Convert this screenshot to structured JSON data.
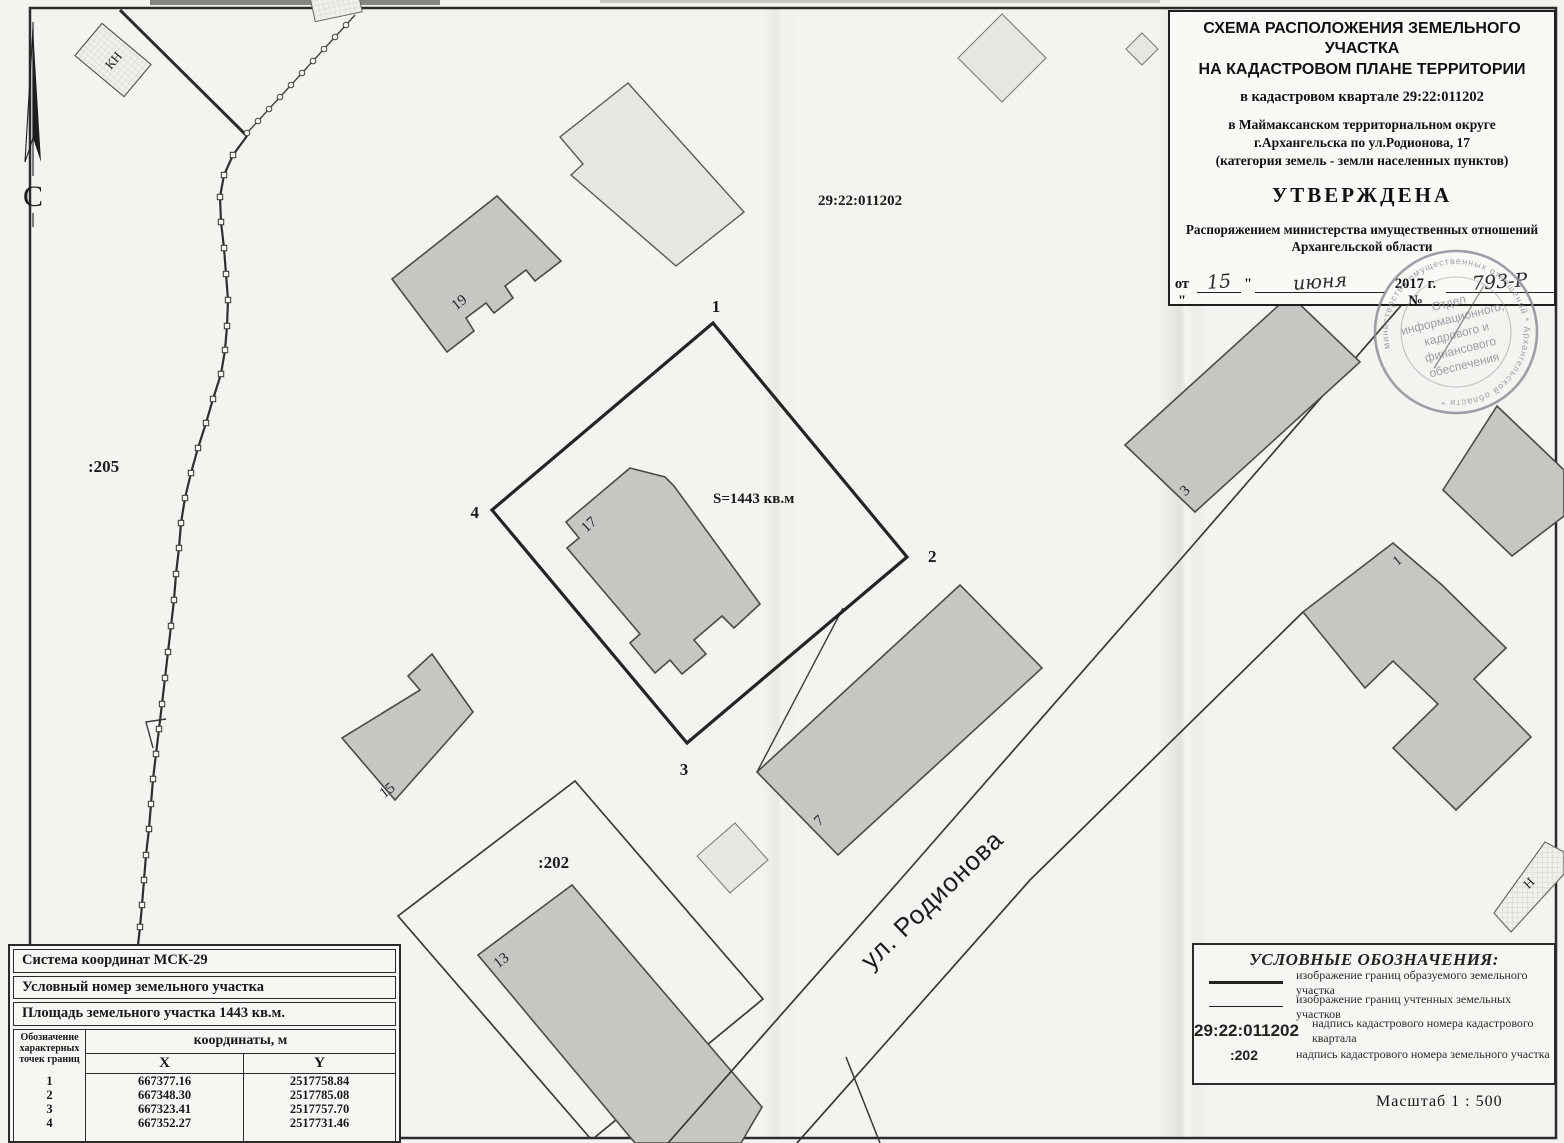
{
  "title_block": {
    "heading_line1": "СХЕМА РАСПОЛОЖЕНИЯ ЗЕМЕЛЬНОГО УЧАСТКА",
    "heading_line2": "НА КАДАСТРОВОМ ПЛАНЕ ТЕРРИТОРИИ",
    "quarter_line": "в кадастровом квартале 29:22:011202",
    "location_line1": "в Маймаксанском территориальном округе",
    "location_line2": "г.Архангельска по ул.Родионова, 17",
    "category_line": "(категория земель - земли населенных пунктов)",
    "approved_word": "УТВЕРЖДЕНА",
    "order_line1": "Распоряжением министерства имущественных отношений",
    "order_line2": "Архангельской области",
    "date_prefix": "от \"",
    "date_day_handwritten": "15",
    "date_quote": "\"",
    "date_month_handwritten": "июня",
    "date_year": "2017 г. №",
    "doc_number_handwritten": "793-Р"
  },
  "stamp": {
    "ring_text": "министерство имущественных отношений  *  Архангельской области  *",
    "line1": "Отдел",
    "line2": "информационного,",
    "line3": "кадрового и",
    "line4": "финансового",
    "line5": "обеспечения"
  },
  "map_labels": {
    "north": "С",
    "kn": "КН",
    "parcel_205": ":205",
    "parcel_202": ":202",
    "quarter_number": "29:22:011202",
    "area": "S=1443 кв.м",
    "street": "ул. Родионова",
    "point1": "1",
    "point2": "2",
    "point3": "3",
    "point4": "4",
    "b19": "19",
    "b17": "17",
    "b15": "15",
    "b13": "13",
    "b7": "7",
    "b3": "3",
    "b1": "1",
    "n_building": "Н"
  },
  "legend": {
    "title": "УСЛОВНЫЕ ОБОЗНАЧЕНИЯ:",
    "item1_label": "изображение границ образуемого земельного участка",
    "item2_label": "изображение границ учтенных земельных участков",
    "item3_symbol": "29:22:011202",
    "item3_label": "надпись кадастрового номера кадастрового квартала",
    "item4_symbol": ":202",
    "item4_label": "надпись кадастрового номера земельного участка"
  },
  "coords_table": {
    "system_row": "Система координат МСК-29",
    "number_row": "Условный номер земельного участка",
    "area_row": "Площадь земельного участка 1443 кв.м.",
    "points_header": "Обозначение характерных точек границ",
    "coords_header": "координаты, м",
    "x_header": "X",
    "y_header": "Y",
    "rows": [
      {
        "n": "1",
        "x": "667377.16",
        "y": "2517758.84"
      },
      {
        "n": "2",
        "x": "667348.30",
        "y": "2517785.08"
      },
      {
        "n": "3",
        "x": "667323.41",
        "y": "2517757.70"
      },
      {
        "n": "4",
        "x": "667352.27",
        "y": "2517731.46"
      }
    ]
  },
  "scale_label": "Масштаб  1 : 500"
}
